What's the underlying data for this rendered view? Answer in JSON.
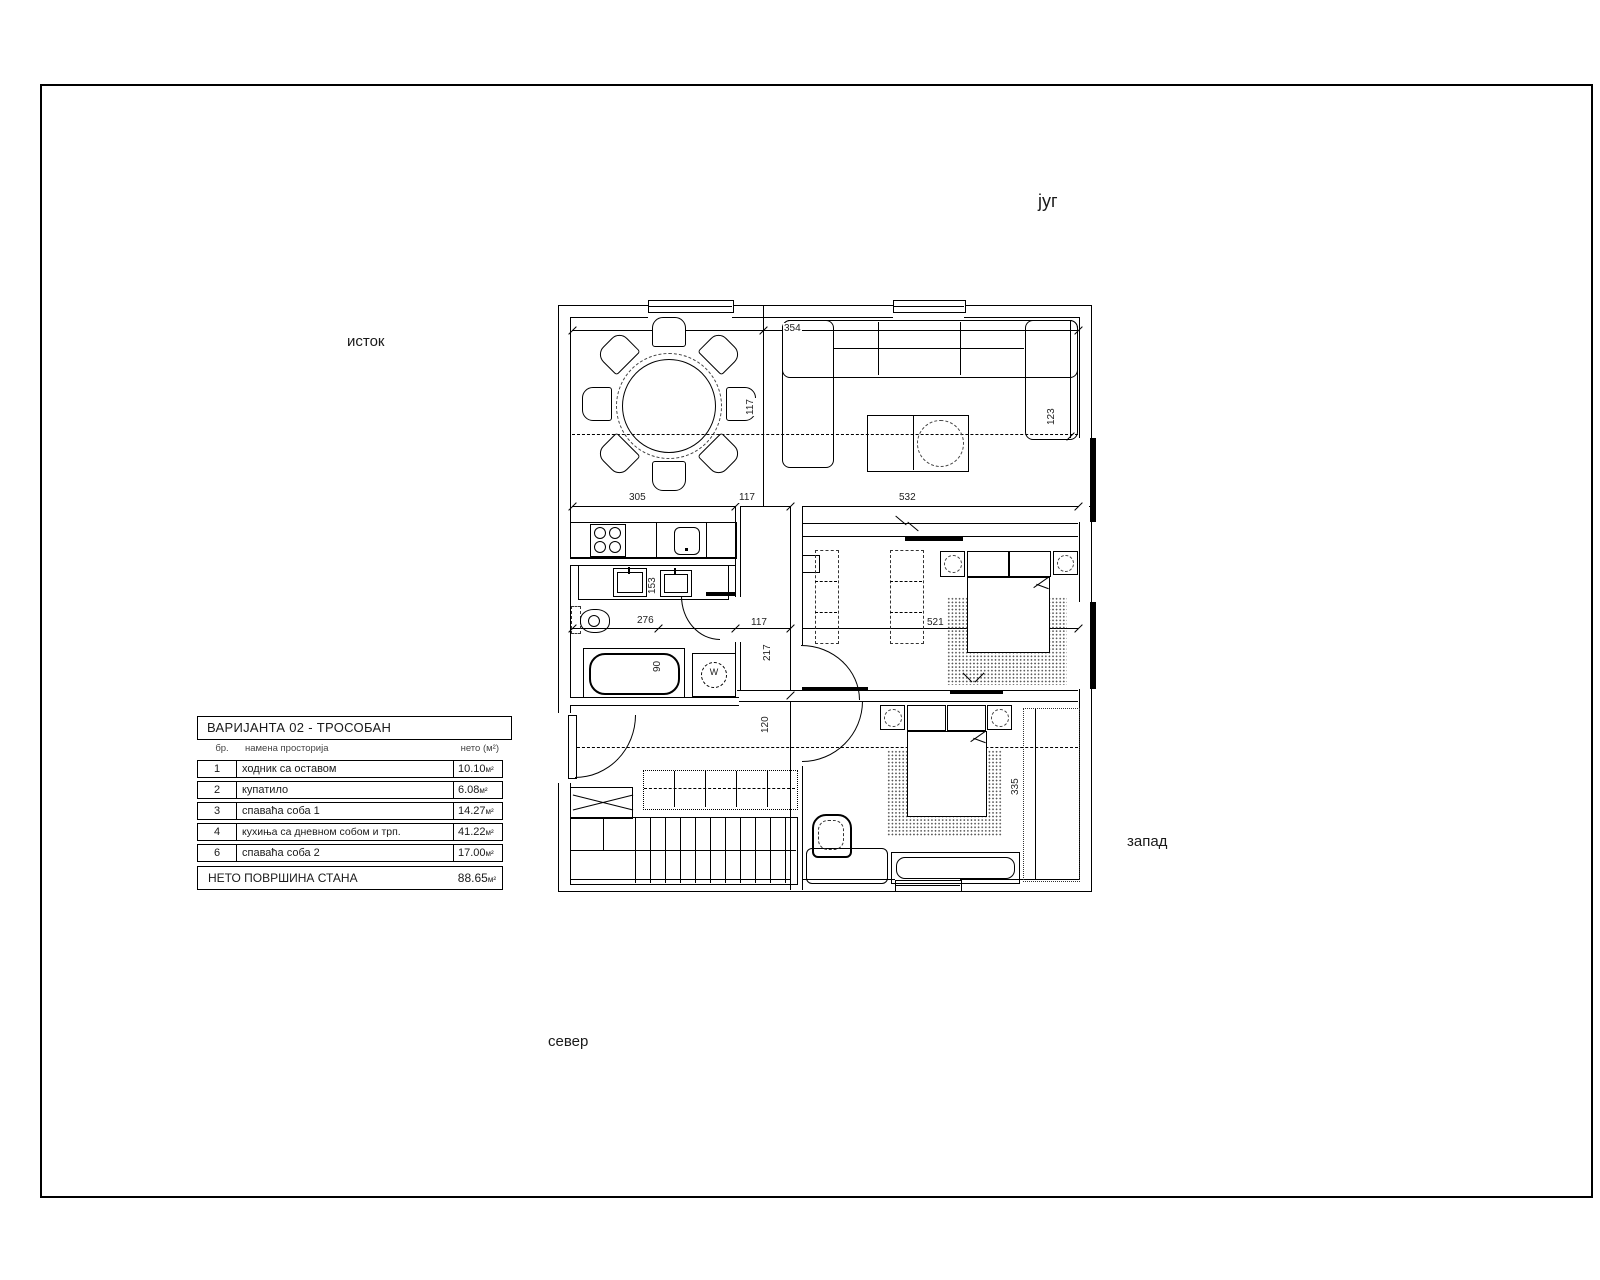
{
  "compass": {
    "south": "југ",
    "east": "исток",
    "west": "запад",
    "north": "север"
  },
  "legend": {
    "title": "ВАРИЈАНТА 02 - ТРОСОБАН",
    "col_num": "бр.",
    "col_name": "намена просторија",
    "col_area": "нето (м²)",
    "rows": [
      {
        "num": "1",
        "name": "ходник са оставом",
        "area": "10.10",
        "unit": "м²"
      },
      {
        "num": "2",
        "name": "купатило",
        "area": "6.08",
        "unit": "м²"
      },
      {
        "num": "3",
        "name": "спаваћа соба 1",
        "area": "14.27",
        "unit": "м²"
      },
      {
        "num": "4",
        "name": "кухиња са дневном собом и трп.",
        "area": "41.22",
        "unit": "м²"
      },
      {
        "num": "6",
        "name": "спаваћа соба 2",
        "area": "17.00",
        "unit": "м²"
      }
    ],
    "total_label": "НЕТО ПОВРШИНА СТАНА",
    "total_area": "88.65",
    "total_unit": "м²"
  },
  "washer_label": "W",
  "dimensions": [
    {
      "text": "354",
      "x": 235,
      "y": 27,
      "vertical": false
    },
    {
      "text": "305",
      "x": 80,
      "y": 196,
      "vertical": false
    },
    {
      "text": "117",
      "x": 190,
      "y": 196,
      "vertical": false
    },
    {
      "text": "532",
      "x": 350,
      "y": 196,
      "vertical": false
    },
    {
      "text": "276",
      "x": 88,
      "y": 319,
      "vertical": false
    },
    {
      "text": "117",
      "x": 202,
      "y": 321,
      "vertical": false
    },
    {
      "text": "521",
      "x": 378,
      "y": 321,
      "vertical": false
    },
    {
      "text": "153",
      "x": 99,
      "y": 299,
      "vertical": true
    },
    {
      "text": "90",
      "x": 104,
      "y": 377,
      "vertical": true
    },
    {
      "text": "217",
      "x": 214,
      "y": 366,
      "vertical": true
    },
    {
      "text": "120",
      "x": 212,
      "y": 438,
      "vertical": true
    },
    {
      "text": "123",
      "x": 498,
      "y": 130,
      "vertical": true
    },
    {
      "text": "335",
      "x": 462,
      "y": 500,
      "vertical": true
    },
    {
      "text": "117",
      "x": 197,
      "y": 120,
      "vertical": true
    }
  ]
}
